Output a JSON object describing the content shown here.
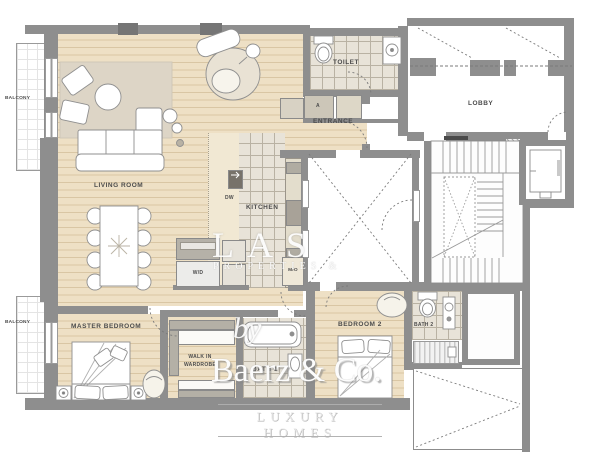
{
  "title": "Apartment floor plan",
  "labels": {
    "balcony_top": "BALCONY",
    "balcony_bottom": "BALCONY",
    "living_room": "LIVING ROOM",
    "toilet": "TOILET",
    "closet_a": "A",
    "entrance": "ENTRANCE",
    "lobby": "LOBBY",
    "kitchen": "KITCHEN",
    "dw": "DW",
    "wd": "W/D",
    "mo": "M/O",
    "master_bedroom": "MASTER BEDROOM",
    "walk_in_line1": "WALK IN",
    "walk_in_line2": "WARDROBE",
    "bath_1": "BATH 1",
    "bedroom_2": "BEDROOM 2",
    "bath_2": "BATH 2"
  },
  "watermark": {
    "big": "LAS",
    "sub": "PROPERTIES &",
    "by": "by",
    "brand": "Baerz & Co.",
    "tagline": "LUXURY HOMES"
  },
  "colors": {
    "wood": "#eee0c5",
    "wood_line": "#d9c6a4",
    "tile": "#e8e3d8",
    "tile_line": "#b9b2a3",
    "wall": "#8e8e8e",
    "label_text": "#4c4c4c",
    "rug": "#ddd5c6",
    "watermark_white": "#fcfcfc"
  }
}
